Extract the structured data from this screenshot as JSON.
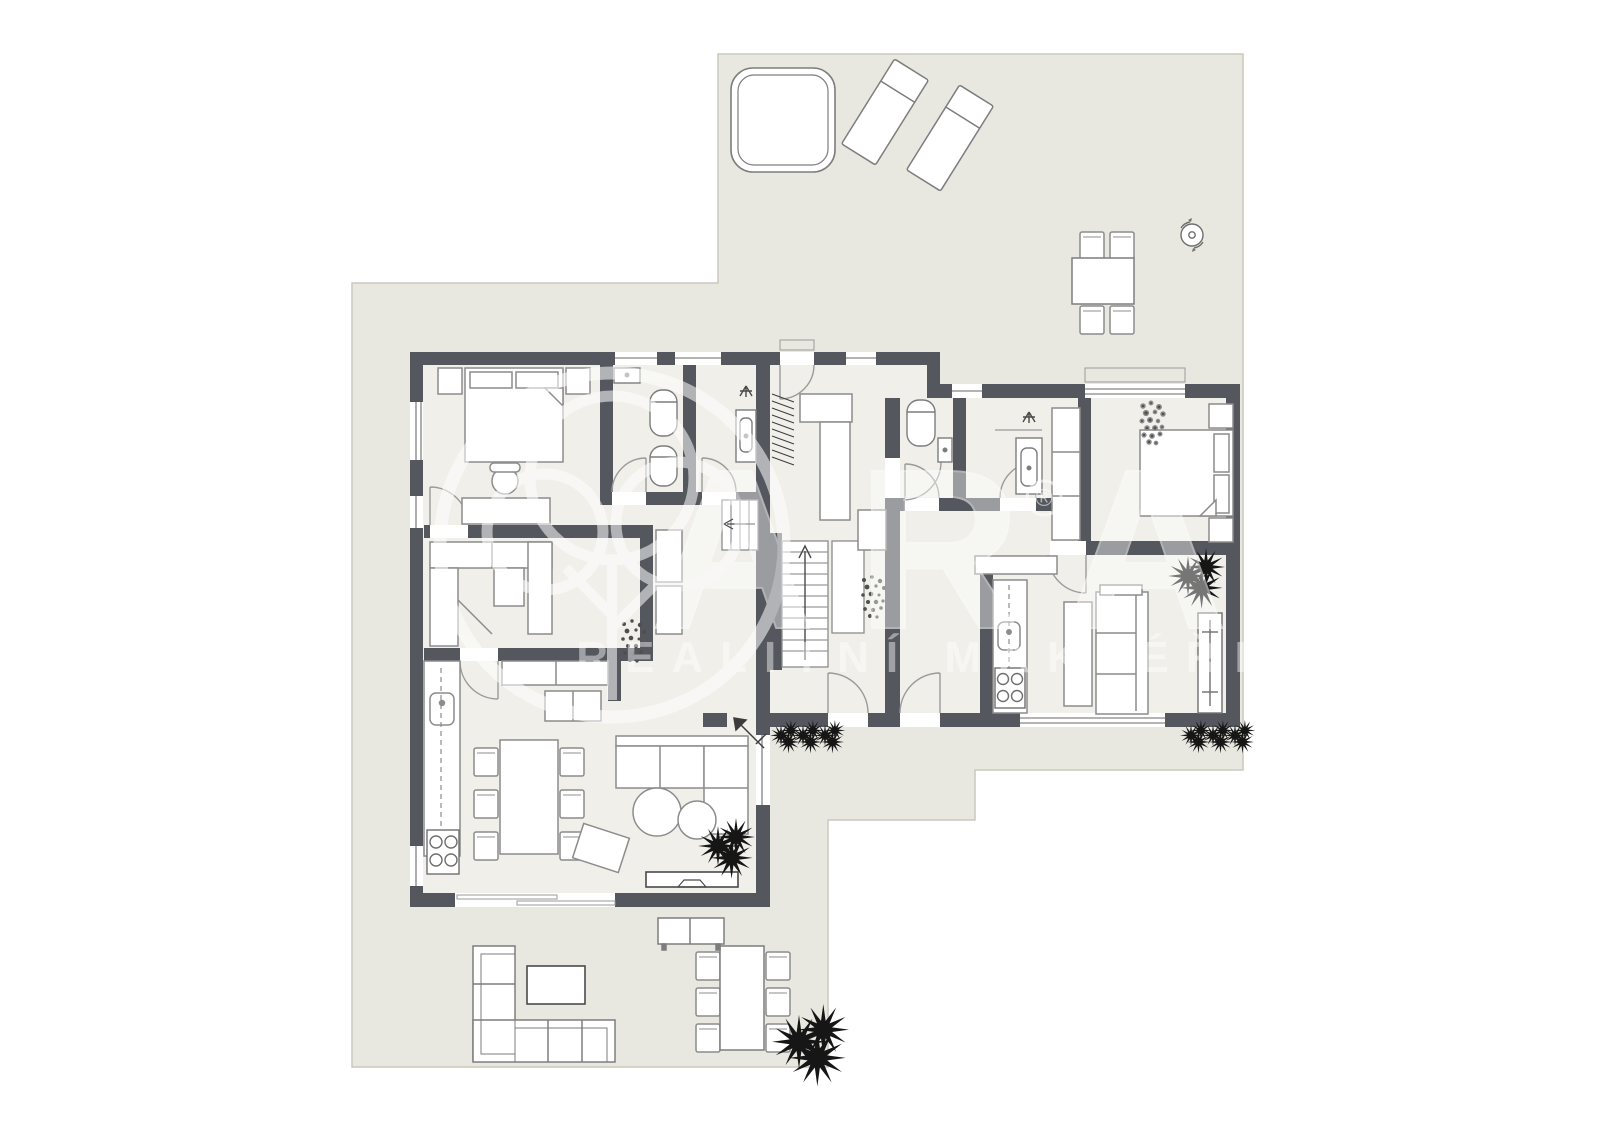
{
  "document": {
    "type": "architectural-floor-plan",
    "storey": "ground floor with terrace"
  },
  "watermark": {
    "logo": "tree-in-circle",
    "brand": "ARA",
    "registered_symbol": "®",
    "tagline": "REALITNÍ MAKLÉŘI",
    "color": "rgba(255,255,255,0.55)"
  },
  "palette": {
    "page_background": "#ffffff",
    "terrace_fill": "#e8e8e0",
    "terrace_edge": "#c9c9bd",
    "floor_fill": "#f0efe9",
    "wall_fill": "#54575d",
    "furniture_fill": "#ffffff",
    "furniture_stroke": "#8c8c8c",
    "dark_stroke": "#4a4a4a",
    "plant_dark": "#161616",
    "plant_speckle": "#4f4f4f",
    "glass_line": "#9a9a9a"
  },
  "legend": {
    "outdoor_items": [
      "hot-tub",
      "sun-lounger",
      "sun-lounger",
      "outdoor-dining-table-4-chairs",
      "rotating-marker",
      "outdoor-corner-sofa",
      "outdoor-coffee-table",
      "outdoor-dining-table-6-chairs",
      "outdoor-sideboard",
      "shrubs-and-trees"
    ],
    "unit_left_items": [
      "double-bed",
      "nightstands",
      "desk-with-chair",
      "toilet",
      "bidet",
      "washbasin",
      "shower",
      "coat-rack",
      "hall-closet",
      "walk-in-wardrobe",
      "staircase-up",
      "staircase-landing",
      "kitchen-counter-sink-cooktop",
      "kitchen-island",
      "dining-table-6-chairs",
      "corner-sofa",
      "round-coffee-tables",
      "ottoman",
      "tv-set"
    ],
    "unit_right_items": [
      "toilet",
      "corner-sink",
      "vanity-washbasin",
      "shower",
      "tall-wardrobe",
      "double-bed",
      "nightstands",
      "kitchen-counter-sink-cooktop",
      "sofa",
      "side-table",
      "bench-shelf",
      "radiator",
      "plants"
    ]
  }
}
